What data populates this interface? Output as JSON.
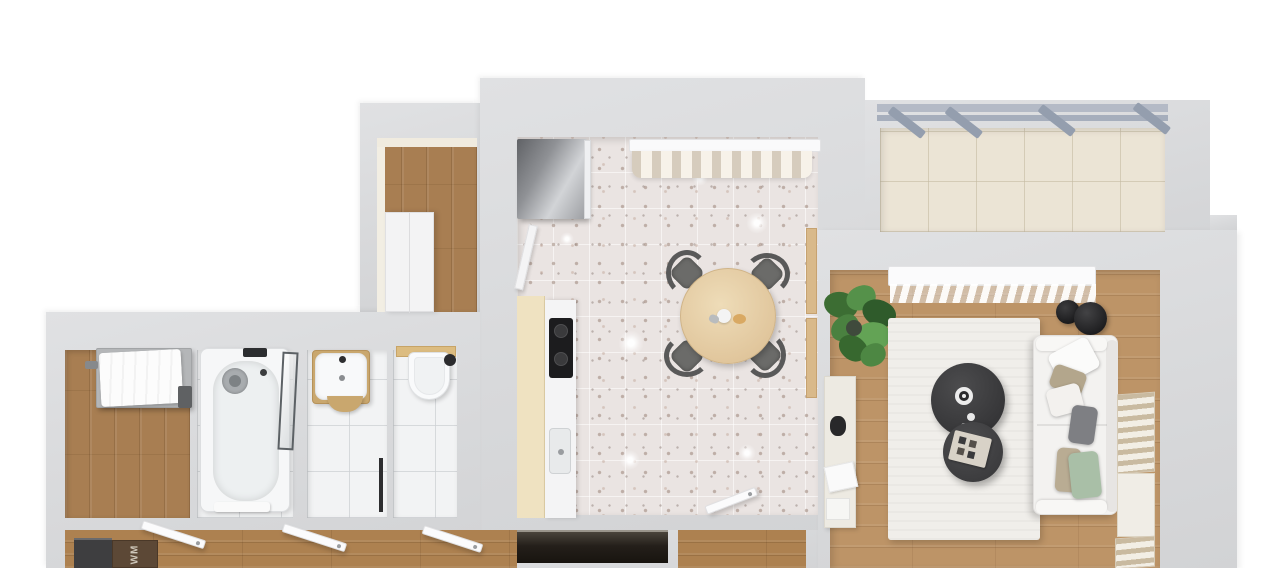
{
  "scene": {
    "description": "3D top-down rendered apartment floor plan",
    "hallway": {
      "doormat_label": "WM"
    },
    "palette": {
      "background": "#ffffff",
      "wall": "#d8d9db",
      "wood_floor": "#ad8150",
      "wood_floor_living": "#bd9467",
      "terrazzo_base": "#eae4e2",
      "balcony_tile": "#ebe4d5",
      "pergola_beam": "#a9b1bf",
      "counter_beige": "#efe2c1",
      "cooktop_black": "#1c1c1e",
      "chair_gray": "#636361",
      "table_wood": "#e5cda6",
      "sofa_white": "#f4f3f1",
      "pillow_green": "#a9bfa7",
      "pillow_gray": "#7e7f83",
      "coffee_table_dark": "#3d3d3f",
      "plant_green": "#4a7c3f",
      "radiator_stripe": "#c9baa0",
      "closet_dark": "#241f1a",
      "doormat_brown": "#5c4836",
      "fridge_gray": "#8f9195"
    },
    "rooms": [
      "storage-room",
      "kitchen-dining",
      "balcony",
      "living-room",
      "bedroom",
      "bathroom",
      "washroom",
      "toilet",
      "hallway"
    ],
    "furniture": [
      "fridge",
      "kitchen-counter",
      "cooktop",
      "kitchen-sink",
      "dining-table",
      "dining-chair",
      "bathtub",
      "shower-screen",
      "washbasin",
      "toilet-bowl",
      "bed",
      "wardrobe",
      "sofa",
      "coffee-table",
      "side-table",
      "rug",
      "plant",
      "radiator",
      "console-table",
      "doormat",
      "bench",
      "door",
      "curtain",
      "pergola"
    ]
  }
}
